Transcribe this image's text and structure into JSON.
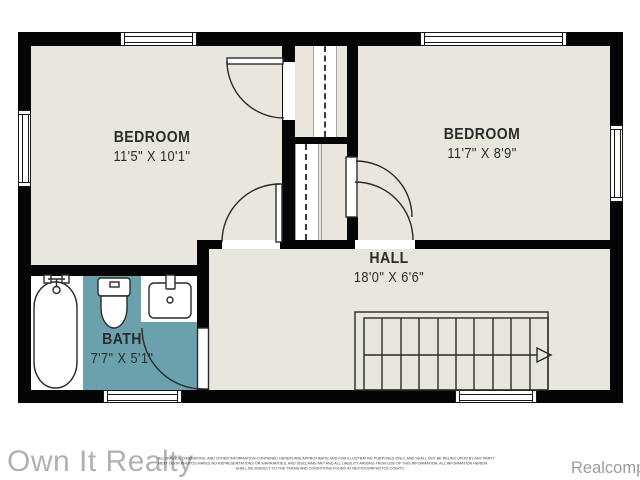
{
  "floorplan": {
    "rooms": [
      {
        "name": "BEDROOM",
        "dims": "11'5\" X 10'1\""
      },
      {
        "name": "BEDROOM",
        "dims": "11'7\" X 8'9\""
      },
      {
        "name": "HALL",
        "dims": "18'0\" X 6'6\""
      },
      {
        "name": "BATH",
        "dims": "7'7\" X 5'1\""
      }
    ],
    "fixtures": [
      "bathtub",
      "toilet",
      "sink",
      "staircase",
      "closet-rod"
    ],
    "colors": {
      "wall": "#050505",
      "floor": "#e8e6dd",
      "bath_floor": "#6ba1ac",
      "fixture_outline": "#2a2a2a"
    }
  },
  "footer": {
    "brand": "Own It Realty",
    "attribution": "Realcomp",
    "disclaimer_lines": [
      "ALL IMAGES, DIMENSIONS, AND OTHER INFORMATION CONTAINED HEREIN ARE APPROXIMATE AND FOR ILLUSTRATIVE PURPOSES ONLY, AND SHALL NOT BE RELIED UPON BY ANY PARTY",
      "NEXT DOOR PHOTOS MAKES NO REPRESENTATIONS OR WARRANTIES, AND DISCLAIMS ANY AND ALL LIABILITY ARISING FROM USE OF THIS INFORMATION. ALL INFORMATION HEREIN",
      "SHALL BE SUBJECT TO THE TERMS AND CONDITIONS FOUND AT NEXTDOORPHOTOS.COM/TC."
    ]
  }
}
